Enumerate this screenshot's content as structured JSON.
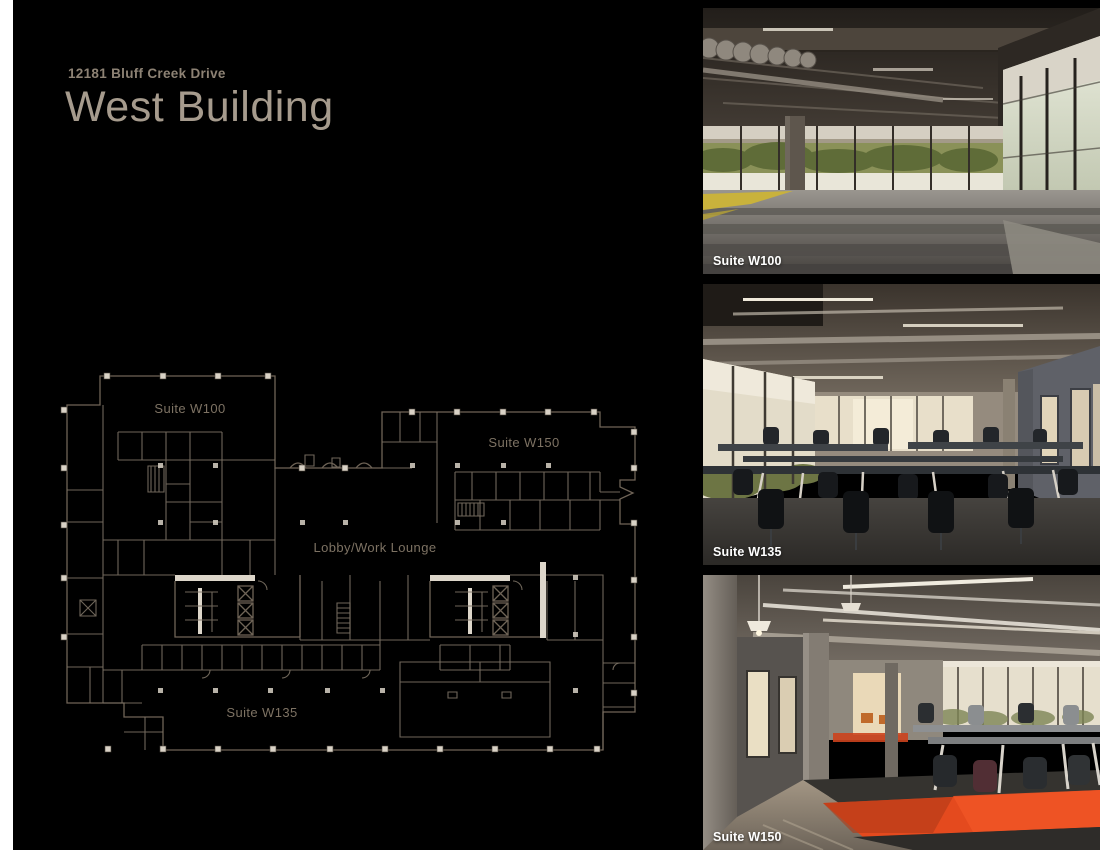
{
  "header": {
    "address": "12181 Bluff Creek Drive",
    "building_name": "West Building"
  },
  "floor_plan": {
    "labels": {
      "suite_w100": "Suite W100",
      "suite_w150": "Suite W150",
      "lobby": "Lobby/Work Lounge",
      "suite_w135": "Suite W135"
    }
  },
  "photos": [
    {
      "caption": "Suite W100"
    },
    {
      "caption": "Suite W135"
    },
    {
      "caption": "Suite W150"
    }
  ],
  "colors": {
    "background": "#000000",
    "left_margin": "#ffffff",
    "address_text": "#8d8274",
    "title_text": "#a69b8d",
    "plan_line": "#6f6457",
    "plan_label": "#7d7263",
    "caption_text": "#ffffff",
    "accent_red": "#e44a1e"
  }
}
